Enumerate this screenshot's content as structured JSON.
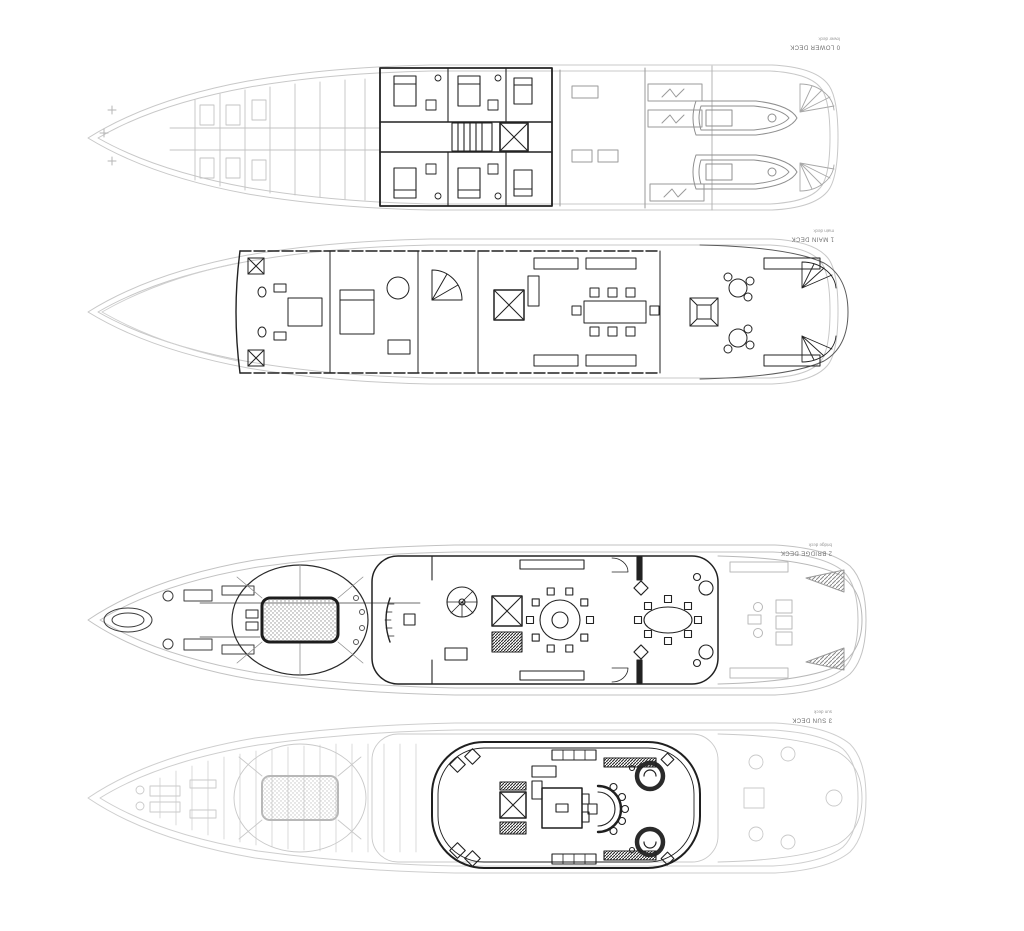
{
  "page": {
    "title": "Yacht general arrangement deck plans",
    "background": "#ffffff"
  },
  "colors": {
    "faint_line": "#c8c8c8",
    "mid_line": "#9a9a9a",
    "dark_line": "#222222",
    "label_text": "#6e6e6e"
  },
  "decks": [
    {
      "id": "lower-deck",
      "label": "0 LOWER DECK",
      "sublabel": "lower deck"
    },
    {
      "id": "main-deck",
      "label": "1 MAIN DECK",
      "sublabel": "main deck"
    },
    {
      "id": "bridge-deck",
      "label": "2 BRIDGE DECK",
      "sublabel": "bridge deck"
    },
    {
      "id": "sun-deck",
      "label": "3 SUN DECK",
      "sublabel": "sun deck"
    }
  ]
}
